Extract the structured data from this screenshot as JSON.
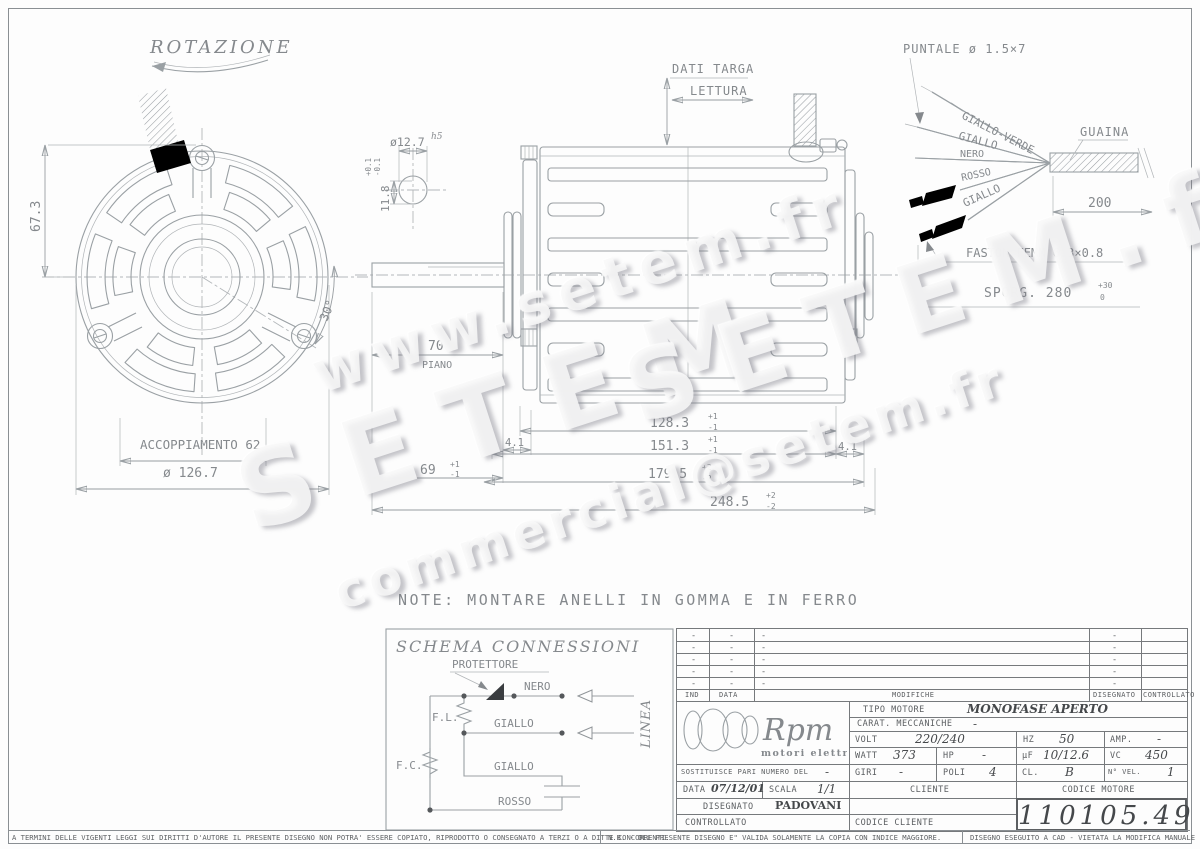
{
  "front_view": {
    "rotation": "ROTAZIONE",
    "dim_67_3": "67.3",
    "accoppiamento": "ACCOPPIAMENTO 62",
    "diameter": "ø 126.7",
    "angle": "30°"
  },
  "shaft_section": {
    "diameter": "ø12.7",
    "fit": "h5",
    "tol_plus": "+0.1",
    "tol_minus": "-0.1",
    "flat": "11.8"
  },
  "side_view": {
    "dati_targa": "DATI TARGA",
    "lettura": "LETTURA",
    "dim_70": "70",
    "piano": "PIANO",
    "dim_4_1_left": "4.1",
    "dim_69": "69",
    "tol_69_plus": "+1",
    "tol_69_minus": "-1",
    "dim_128_3": "128.3",
    "tol_128_plus": "+1",
    "tol_128_minus": "-1",
    "dim_151_3": "151.3",
    "tol_151_plus": "+1",
    "tol_151_minus": "-1",
    "dim_4_1_right": "4.1",
    "dim_179_5": "179.5",
    "tol_179_plus": "+2",
    "tol_179_minus": "-2",
    "dim_248_5": "248.5",
    "tol_248_plus": "+2",
    "tol_248_minus": "-2"
  },
  "cable_detail": {
    "puntale": "PUNTALE ø 1.5×7",
    "guaina": "GUAINA",
    "wire_giallo_verde": "GIALLO-VERDE",
    "wire_giallo_top": "GIALLO",
    "wire_nero": "NERO",
    "wire_rosso": "ROSSO",
    "wire_giallo_bottom": "GIALLO",
    "dim_200": "200",
    "faston": "FASTON FEMM 6.3×0.8",
    "sporg": "SPORG. 280",
    "sporg_tol_plus": "+30",
    "sporg_tol_minus": "0"
  },
  "note": "NOTE: MONTARE ANELLI IN GOMMA E IN FERRO",
  "schema": {
    "title": "SCHEMA CONNESSIONI",
    "protettore": "PROTETTORE",
    "nero": "NERO",
    "giallo_1": "GIALLO",
    "giallo_2": "GIALLO",
    "rosso": "ROSSO",
    "fl": "F.L.",
    "fc": "F.C.",
    "linea": "LINEA"
  },
  "revisions": {
    "col_ind": "IND",
    "col_data": "DATA",
    "col_modifiche": "MODIFICHE",
    "col_disegnato": "DISEGNATO",
    "col_controllato": "CONTROLLATO",
    "rows": [
      {
        "ind": "-",
        "data": "-",
        "modifiche": "-",
        "disegnato": "-",
        "controllato": ""
      },
      {
        "ind": "-",
        "data": "-",
        "modifiche": "-",
        "disegnato": "-",
        "controllato": ""
      },
      {
        "ind": "-",
        "data": "-",
        "modifiche": "-",
        "disegnato": "-",
        "controllato": ""
      },
      {
        "ind": "-",
        "data": "-",
        "modifiche": "-",
        "disegnato": "-",
        "controllato": ""
      },
      {
        "ind": "-",
        "data": "-",
        "modifiche": "-",
        "disegnato": "-",
        "controllato": ""
      }
    ]
  },
  "title_block": {
    "logo": "Rpm",
    "logo_sub": "motori elettrici",
    "tipo_motore_label": "TIPO MOTORE",
    "tipo_motore_value": "MONOFASE APERTO",
    "carat_label": "CARAT. MECCANICHE",
    "carat_value": "-",
    "volt_label": "VOLT",
    "volt_value": "220/240",
    "hz_label": "HZ",
    "hz_value": "50",
    "amp_label": "AMP.",
    "amp_value": "-",
    "watt_label": "WATT",
    "watt_value": "373",
    "hp_label": "HP",
    "hp_value": "-",
    "uf_label": "µF",
    "uf_value": "10/12.6",
    "vc_label": "VC",
    "vc_value": "450",
    "giri_label": "GIRI",
    "giri_value": "-",
    "poli_label": "POLI",
    "poli_value": "4",
    "cl_label": "CL.",
    "cl_value": "B",
    "nvel_label": "N° VEL.",
    "nvel_value": "1",
    "sostituisce_label": "SOSTITUISCE PARI NUMERO DEL",
    "sostituisce_value": "-",
    "data_label": "DATA",
    "data_value": "07/12/01",
    "scala_label": "SCALA",
    "scala_value": "1/1",
    "cliente_label": "CLIENTE",
    "codice_motore_label": "CODICE MOTORE",
    "disegnato_label": "DISEGNATO",
    "disegnato_value": "PADOVANI",
    "controllato_label": "CONTROLLATO",
    "codice_cliente_label": "CODICE CLIENTE",
    "codice_motore_value": "110105.49"
  },
  "footer": {
    "left": "A TERMINI DELLE VIGENTI LEGGI SUI DIRITTI D'AUTORE IL PRESENTE DISEGNO NON POTRA' ESSERE COPIATO, RIPRODOTTO O CONSEGNATO A TERZI O A DITTE CONCORRENTI.",
    "nb": "N.B. - DEL PRESENTE DISEGNO E\" VALIDA SOLAMENTE LA COPIA CON INDICE MAGGIORE.",
    "cad": "DISEGNO ESEGUITO A CAD - VIETATA LA MODIFICA MANUALE"
  },
  "watermarks": {
    "w1": "www.setem.fr",
    "w2": "SETEM",
    "w3": "commercial@setem.fr",
    "w4": "SETEM.fr"
  }
}
